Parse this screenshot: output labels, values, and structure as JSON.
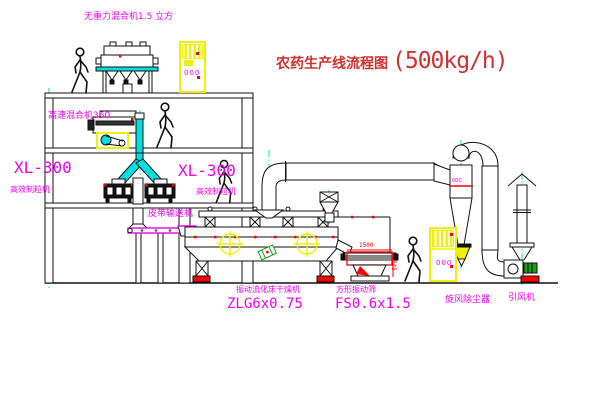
{
  "diagram": {
    "title": "农药生产线流程图",
    "capacity": "(500kg/h)",
    "equipment_labels": {
      "gravity_mixer": "无重力混合机1.5 立方",
      "high_speed_mixer": "高速混合机350",
      "granulator_left_model": "XL-300",
      "granulator_left_name": "高效制粒机",
      "granulator_right_model": "XL-300",
      "granulator_right_name": "高效制粒机",
      "belt_conveyor": "皮带输送机",
      "dryer_name": "振动流化床干燥机",
      "dryer_model": "ZLG6x0.75",
      "sieve_name": "方形振动筛",
      "sieve_model": "FS0.6x1.5",
      "cyclone": "旋风除尘器",
      "induced_draft_fan": "引风机"
    },
    "dimensions": {
      "sieve_length": "1500",
      "sieve_height": "545",
      "cyclone_diameter": "600"
    },
    "cabinet_display": "000",
    "colors": {
      "label_magenta": "#f000f0",
      "title_red": "#d23030",
      "centerline_cyan": "#00e0e0",
      "highlight_yellow": "#f0f000",
      "alert_red": "#ff0000",
      "machine_dark": "#111111"
    }
  }
}
